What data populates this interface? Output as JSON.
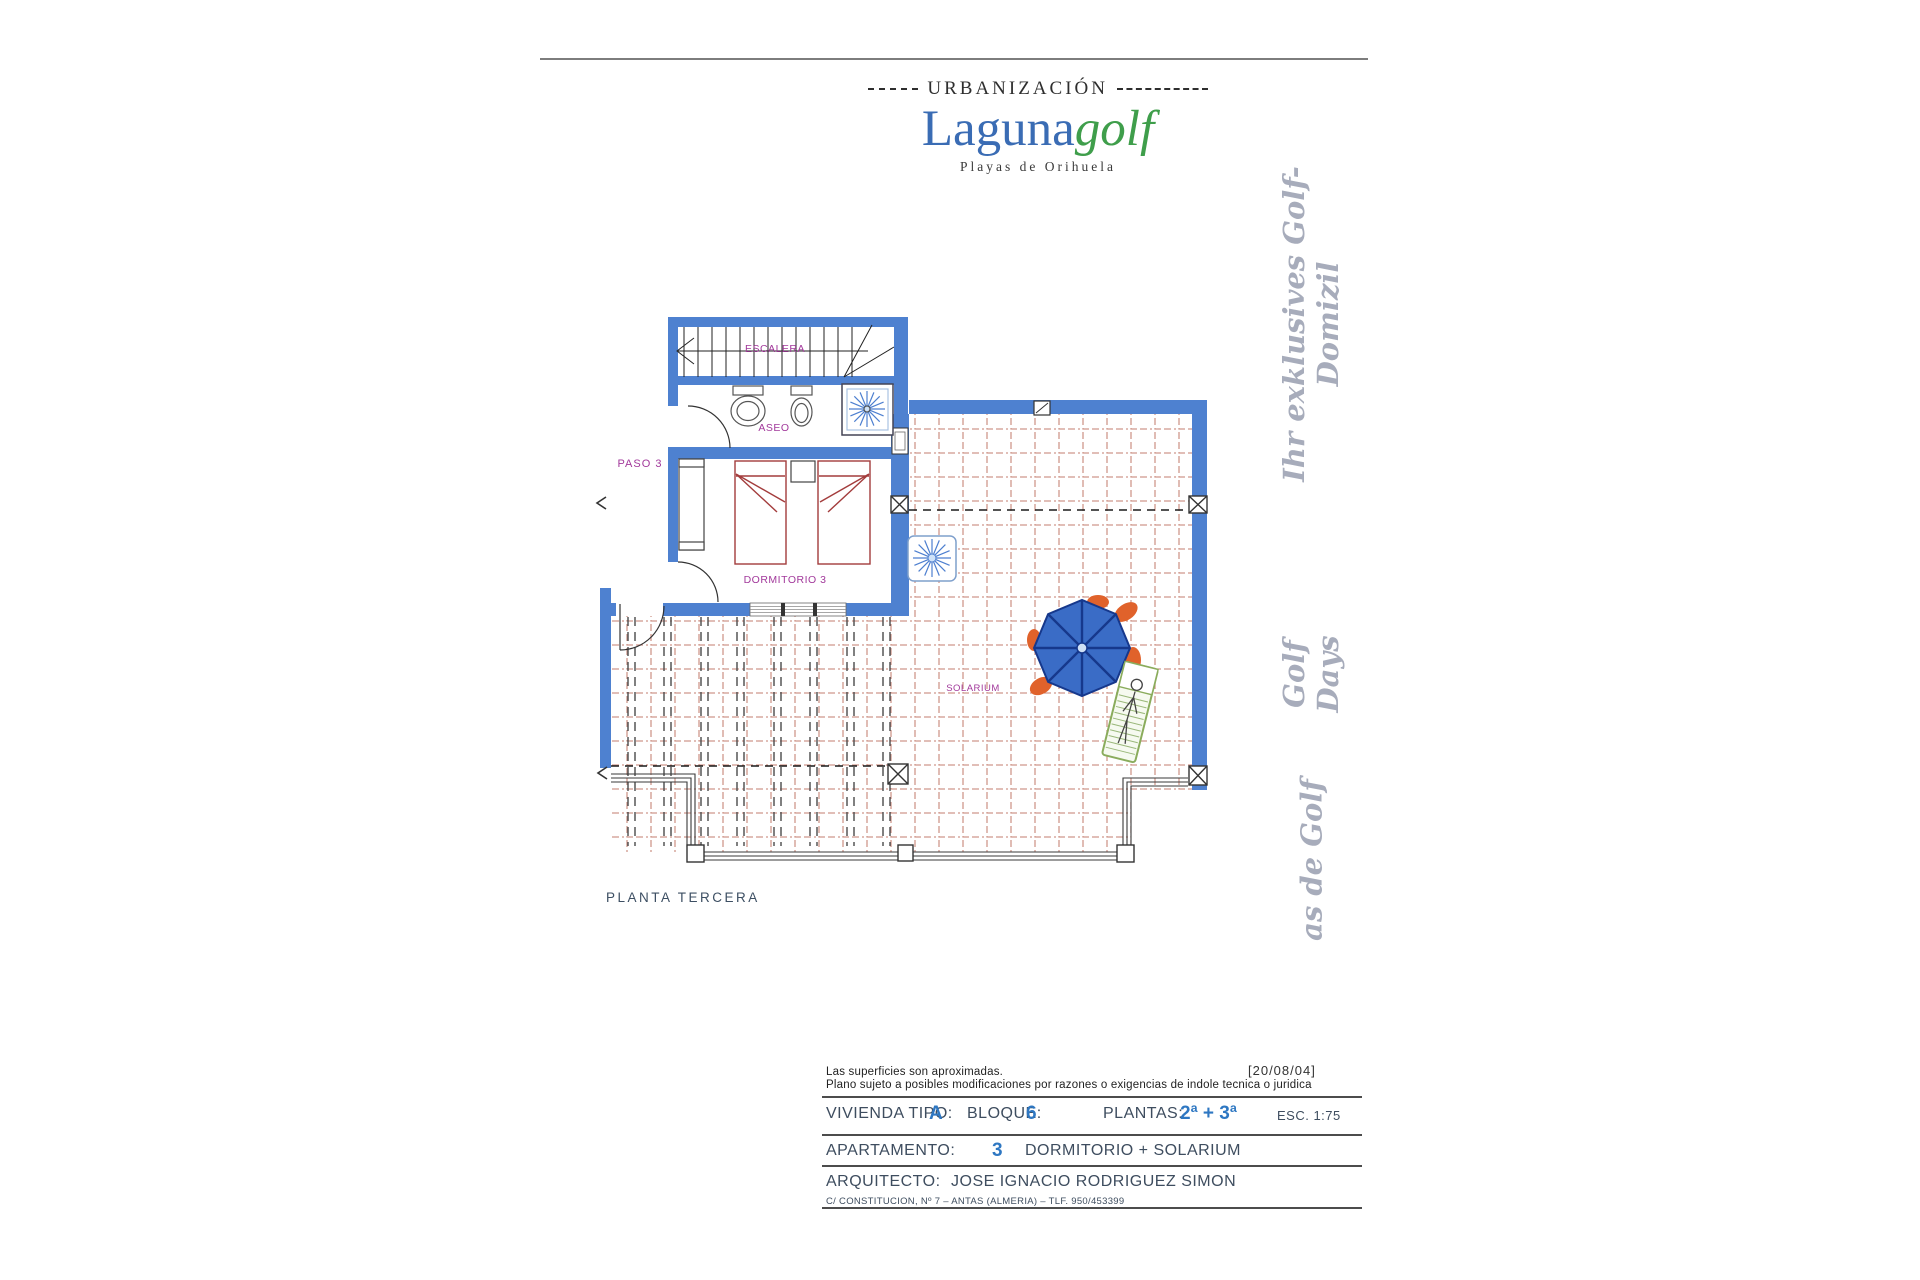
{
  "header": {
    "urbanizacion": "URBANIZACIÓN",
    "brand_a": "Laguna",
    "brand_b": "golf",
    "subtitle": "Playas de Orihuela"
  },
  "side_texts": {
    "domizil": "Ihr exklusives Golf-Domizil",
    "golf_days": "Golf Days",
    "casas": "as de Golf"
  },
  "plan": {
    "labels": {
      "escalera": "ESCALERA",
      "aseo": "ASEO",
      "paso": "PASO 3",
      "dormitorio": "DORMITORIO 3",
      "solarium": "SOLARIUM",
      "planta": "PLANTA TERCERA"
    },
    "colors": {
      "wall_blue": "#4e81d0",
      "tile_line": "#cf978c",
      "room_label": "#a2399b",
      "bed_outline": "#a33c3c",
      "umbrella_blue": "#3a6cc6",
      "chair_orange": "#e0622b",
      "lounger_green": "#8aac5c"
    }
  },
  "footer": {
    "date": "[20/08/04]",
    "disclaimer1": "Las superficies son aproximadas.",
    "disclaimer2": "Plano sujeto a posibles modificaciones por razones o exigencias de indole tecnica o juridica",
    "r1_l1": "VIVIENDA TIPO:",
    "r1_v1": "A",
    "r1_l2": "BLOQUE:",
    "r1_v2": "6",
    "r1_l3": "PLANTAS:",
    "r1_v3": "2ª + 3ª",
    "r1_esc": "ESC. 1:75",
    "r2_l": "APARTAMENTO:",
    "r2_v": "3",
    "r2_desc": "DORMITORIO + SOLARIUM",
    "r3_l": "ARQUITECTO:",
    "r3_v": "JOSE IGNACIO RODRIGUEZ SIMON",
    "address": "C/ CONSTITUCION, Nº 7 – ANTAS (ALMERIA) – TLF. 950/453399"
  }
}
